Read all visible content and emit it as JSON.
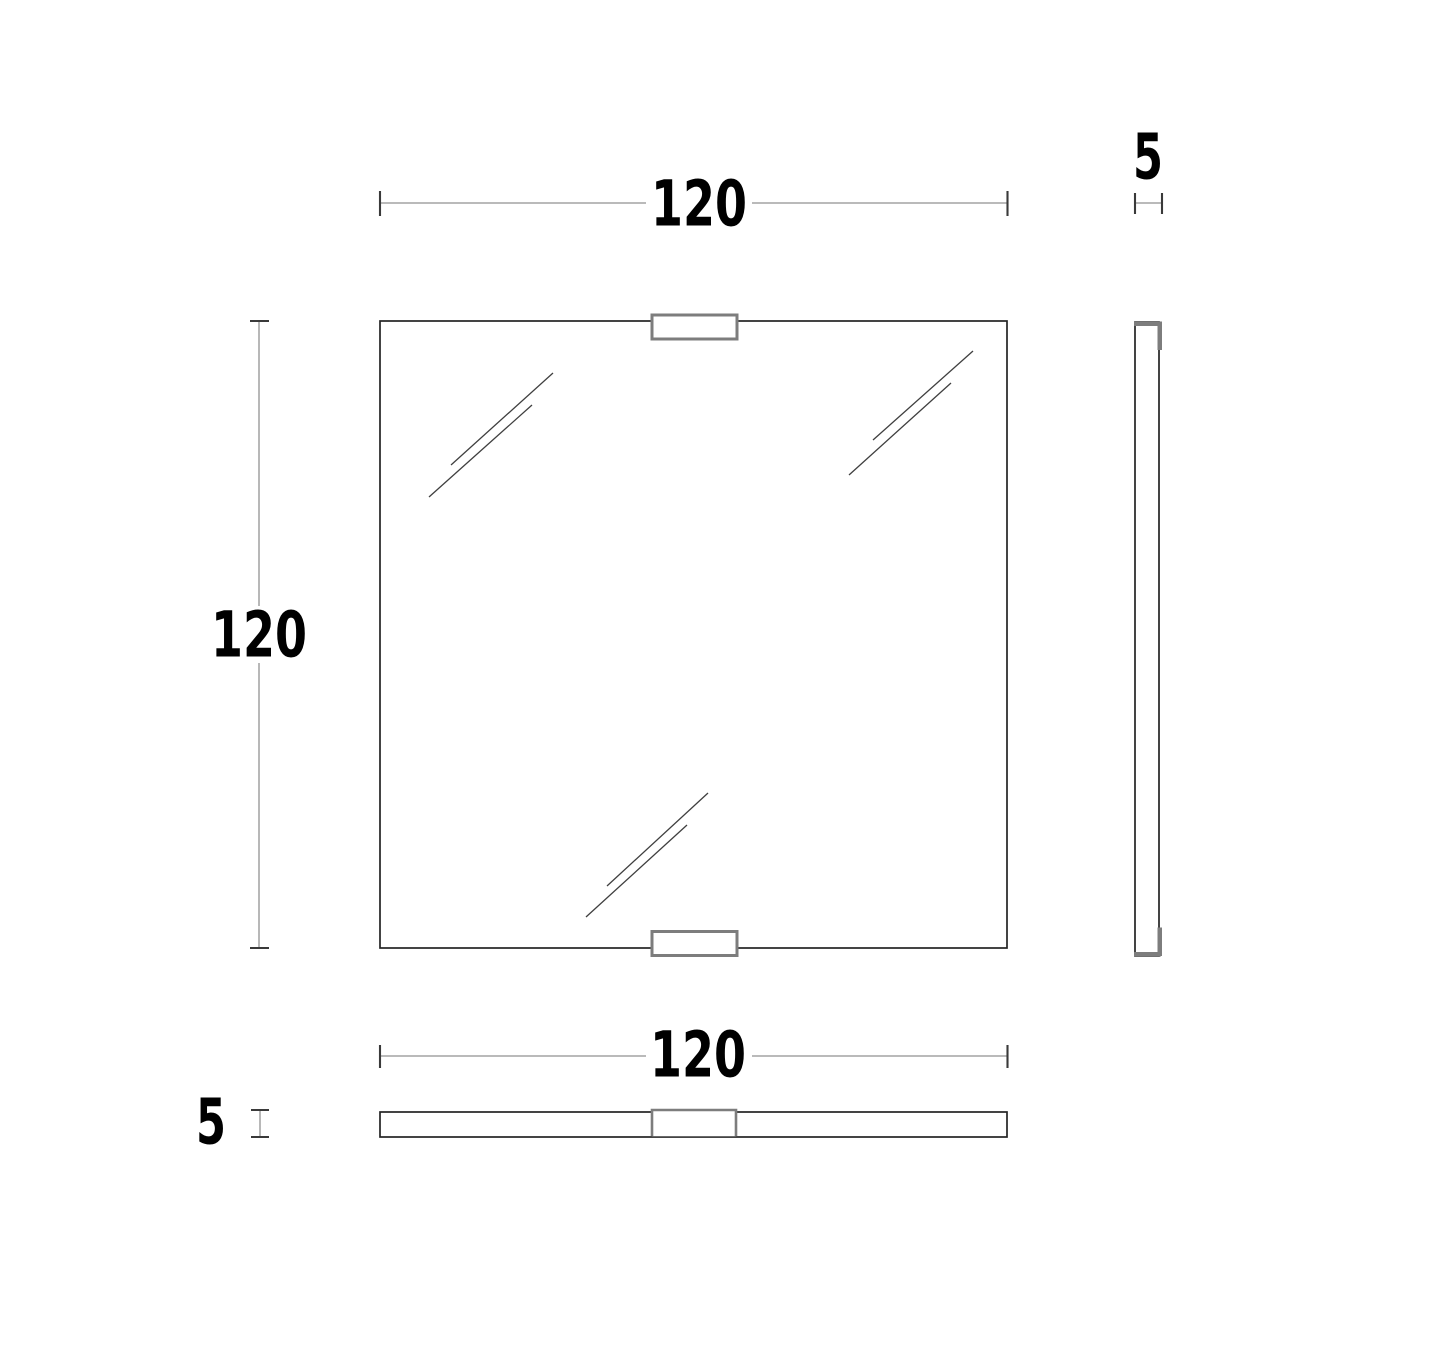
{
  "page": {
    "background": "#ffffff"
  },
  "drawing": {
    "type": "technical-drawing",
    "subject": "square panel (mirror) with two mounting clips, three orthographic views",
    "views": {
      "front": {
        "width_dim": "120",
        "height_dim": "120"
      },
      "side": {
        "thickness_dim": "5"
      },
      "top": {
        "width_dim": "120",
        "thickness_dim": "5"
      }
    },
    "colors": {
      "outline": "#232323",
      "clip": "#7d7d7d",
      "dim_line": "#b0b0b0",
      "dim_tick": "#3a3a3a",
      "label": "#000000",
      "background": "#ffffff"
    }
  }
}
